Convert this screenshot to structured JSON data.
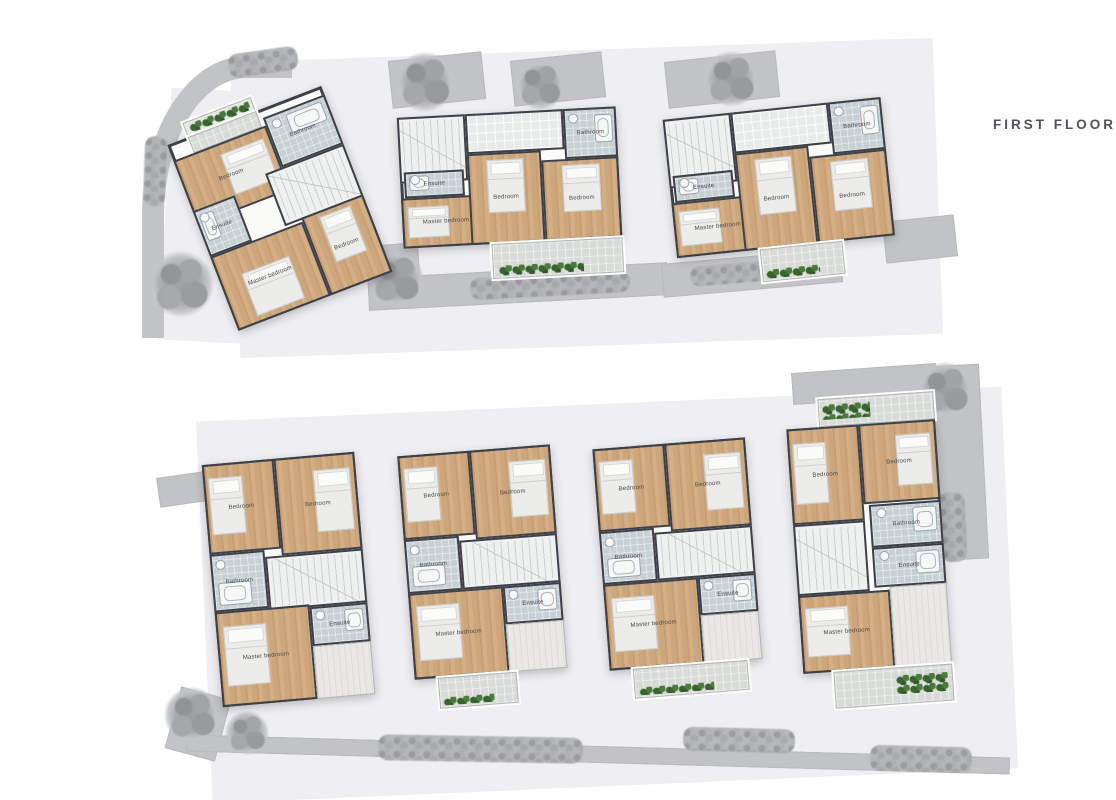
{
  "title": "FIRST FLOOR",
  "colors": {
    "wall": "#3d4147",
    "wood_floor": "#cfa97f",
    "bathroom_tile": "#c6d0d5",
    "paving": "#c2c3c5",
    "plot": "#efeff1",
    "plants": "#41702f",
    "title_text": "#4f5358"
  },
  "labels": {
    "bedroom": "Bedroom",
    "master": "Master bedroom",
    "bathroom": "Bathroom",
    "ensuite": "Ensuite"
  },
  "site": {
    "plots": [
      {
        "x": 235,
        "y": 50,
        "w": 703,
        "h": 296,
        "r": -2
      },
      {
        "x": 204,
        "y": 404,
        "w": 806,
        "h": 382,
        "r": -2.5
      },
      {
        "x": 165,
        "y": 90,
        "w": 95,
        "h": 252,
        "r": 3
      }
    ],
    "paving": [
      {
        "x": 390,
        "y": 56,
        "w": 94,
        "h": 48,
        "r": -6
      },
      {
        "x": 512,
        "y": 56,
        "w": 92,
        "h": 46,
        "r": -6
      },
      {
        "x": 666,
        "y": 56,
        "w": 112,
        "h": 47,
        "r": -6
      },
      {
        "x": 368,
        "y": 244,
        "w": 52,
        "h": 62,
        "r": -4
      },
      {
        "x": 368,
        "y": 270,
        "w": 300,
        "h": 33,
        "r": -3
      },
      {
        "x": 662,
        "y": 256,
        "w": 180,
        "h": 34,
        "r": -5
      },
      {
        "x": 884,
        "y": 218,
        "w": 72,
        "h": 42,
        "r": -6
      },
      {
        "x": 928,
        "y": 365,
        "w": 56,
        "h": 195,
        "r": -3
      },
      {
        "x": 792,
        "y": 368,
        "w": 145,
        "h": 32,
        "r": -4
      },
      {
        "x": 172,
        "y": 692,
        "w": 52,
        "h": 64,
        "r": 15
      },
      {
        "x": 158,
        "y": 474,
        "w": 55,
        "h": 30,
        "r": -8
      },
      {
        "x": 186,
        "y": 746,
        "w": 824,
        "h": 17,
        "r": 1.6
      }
    ],
    "hedges": [
      {
        "x": 228,
        "y": 50,
        "w": 70,
        "h": 24,
        "r": -8
      },
      {
        "x": 144,
        "y": 136,
        "w": 22,
        "h": 70,
        "r": 2
      },
      {
        "x": 470,
        "y": 274,
        "w": 160,
        "h": 22,
        "r": -3
      },
      {
        "x": 690,
        "y": 262,
        "w": 115,
        "h": 20,
        "r": -5
      },
      {
        "x": 378,
        "y": 736,
        "w": 205,
        "h": 26,
        "r": 1
      },
      {
        "x": 683,
        "y": 728,
        "w": 112,
        "h": 24,
        "r": 1.5
      },
      {
        "x": 870,
        "y": 746,
        "w": 102,
        "h": 26,
        "r": 1.5
      },
      {
        "x": 940,
        "y": 492,
        "w": 26,
        "h": 70,
        "r": -3
      }
    ],
    "trees": [
      {
        "x": 425,
        "y": 82,
        "d": 60
      },
      {
        "x": 540,
        "y": 85,
        "d": 50
      },
      {
        "x": 731,
        "y": 79,
        "d": 56
      },
      {
        "x": 181,
        "y": 284,
        "d": 66
      },
      {
        "x": 396,
        "y": 279,
        "d": 56
      },
      {
        "x": 945,
        "y": 390,
        "d": 56
      },
      {
        "x": 192,
        "y": 715,
        "d": 56
      },
      {
        "x": 247,
        "y": 733,
        "d": 44
      }
    ]
  },
  "houses": [
    {
      "x": 186,
      "y": 96,
      "w": 174,
      "h": 214,
      "r": -21,
      "shell": {
        "l": 5,
        "t": 7,
        "w": 95,
        "h": 93
      },
      "rooms": [
        {
          "type": "planter",
          "l": 18,
          "t": 0,
          "w": 42,
          "h": 7,
          "plants": "full"
        },
        {
          "type": "balcony",
          "l": 18,
          "t": 7,
          "w": 42,
          "h": 8
        },
        {
          "type": "bedroom",
          "label": "Bedroom",
          "l": 5,
          "t": 15,
          "w": 57,
          "h": 32,
          "bed": "right"
        },
        {
          "type": "bath",
          "label": "Bathroom",
          "l": 62,
          "t": 11,
          "w": 38,
          "h": 25,
          "tub": "top"
        },
        {
          "type": "stairs",
          "l": 52,
          "t": 36,
          "w": 48,
          "h": 26
        },
        {
          "type": "ensuite",
          "label": "Ensuite",
          "l": 5,
          "t": 40,
          "w": 26,
          "h": 23,
          "tub": "left"
        },
        {
          "type": "master",
          "label": "Master bedroom",
          "l": 5,
          "t": 63,
          "w": 57,
          "h": 37,
          "bed": "bottom"
        },
        {
          "type": "bedroom",
          "label": "Bedroom",
          "l": 62,
          "t": 61,
          "w": 38,
          "h": 39,
          "bed": "top"
        }
      ]
    },
    {
      "x": 401,
      "y": 112,
      "w": 219,
      "h": 166,
      "r": -3,
      "shell": {
        "l": 0,
        "t": 0,
        "w": 100,
        "h": 79
      },
      "rooms": [
        {
          "type": "stairs",
          "l": 0,
          "t": 0,
          "w": 31,
          "h": 40
        },
        {
          "type": "tile",
          "l": 31,
          "t": 0,
          "w": 45,
          "h": 24
        },
        {
          "type": "bath",
          "label": "Bathroom",
          "l": 76,
          "t": 0,
          "w": 24,
          "h": 30,
          "tub": "right"
        },
        {
          "type": "ensuite",
          "label": "Ensuite",
          "l": 2,
          "t": 33,
          "w": 27,
          "h": 16,
          "tub": "left"
        },
        {
          "type": "master",
          "label": "Master bedroom",
          "l": 0,
          "t": 49,
          "w": 40,
          "h": 30,
          "bed": "left"
        },
        {
          "type": "bedroom",
          "label": "Bedroom",
          "l": 31,
          "t": 24,
          "w": 34,
          "h": 55,
          "bed": "top"
        },
        {
          "type": "bedroom",
          "label": "Bedroom",
          "l": 65,
          "t": 30,
          "w": 35,
          "h": 49,
          "bed": "top"
        },
        {
          "type": "balcony",
          "l": 40,
          "t": 79,
          "w": 60,
          "h": 21,
          "plants": "bottom"
        }
      ]
    },
    {
      "x": 671,
      "y": 108,
      "w": 219,
      "h": 172,
      "r": -6,
      "shell": {
        "l": 0,
        "t": 0,
        "w": 100,
        "h": 81
      },
      "rooms": [
        {
          "type": "stairs",
          "l": 0,
          "t": 0,
          "w": 31,
          "h": 40
        },
        {
          "type": "tile",
          "l": 31,
          "t": 0,
          "w": 45,
          "h": 24
        },
        {
          "type": "bath",
          "label": "Bathroom",
          "l": 76,
          "t": 0,
          "w": 24,
          "h": 30,
          "tub": "right"
        },
        {
          "type": "ensuite",
          "label": "Ensuite",
          "l": 2,
          "t": 33,
          "w": 27,
          "h": 16,
          "tub": "left"
        },
        {
          "type": "master",
          "label": "Master bedroom",
          "l": 0,
          "t": 49,
          "w": 40,
          "h": 32,
          "bed": "left"
        },
        {
          "type": "bedroom",
          "label": "Bedroom",
          "l": 31,
          "t": 24,
          "w": 34,
          "h": 57,
          "bed": "top"
        },
        {
          "type": "bedroom",
          "label": "Bedroom",
          "l": 65,
          "t": 30,
          "w": 35,
          "h": 51,
          "bed": "top"
        },
        {
          "type": "balcony",
          "l": 38,
          "t": 81,
          "w": 38,
          "h": 19,
          "plants": "bottom"
        }
      ]
    },
    {
      "x": 212,
      "y": 458,
      "w": 153,
      "h": 243,
      "r": -5,
      "shell": {
        "l": 0,
        "t": 0,
        "w": 100,
        "h": 100
      },
      "rooms": [
        {
          "type": "bedroom",
          "label": "Bedroom",
          "l": 0,
          "t": 0,
          "w": 47,
          "h": 37,
          "bed": "left"
        },
        {
          "type": "bedroom",
          "label": "Bedroom",
          "l": 47,
          "t": 0,
          "w": 53,
          "h": 40,
          "bed": "right"
        },
        {
          "type": "bath",
          "label": "Bathroom",
          "l": 0,
          "t": 37,
          "w": 36,
          "h": 24,
          "tub": "bottom"
        },
        {
          "type": "stairs",
          "l": 36,
          "t": 40,
          "w": 64,
          "h": 22
        },
        {
          "type": "ensuite",
          "label": "Ensuite",
          "l": 62,
          "t": 62,
          "w": 38,
          "h": 16,
          "tub": "right"
        },
        {
          "type": "master",
          "label": "Master bedroom",
          "l": 0,
          "t": 61,
          "w": 62,
          "h": 39,
          "bed": "left"
        },
        {
          "type": "closet",
          "l": 62,
          "t": 78,
          "w": 38,
          "h": 22
        }
      ]
    },
    {
      "x": 407,
      "y": 450,
      "w": 153,
      "h": 255,
      "r": -4.5,
      "shell": {
        "l": 0,
        "t": 0,
        "w": 100,
        "h": 88
      },
      "rooms": [
        {
          "type": "bedroom",
          "label": "Bedroom",
          "l": 0,
          "t": 0,
          "w": 47,
          "h": 33,
          "bed": "left"
        },
        {
          "type": "bedroom",
          "label": "Bedroom",
          "l": 47,
          "t": 0,
          "w": 53,
          "h": 35,
          "bed": "right"
        },
        {
          "type": "bath",
          "label": "Bathroom",
          "l": 0,
          "t": 33,
          "w": 36,
          "h": 21,
          "tub": "bottom"
        },
        {
          "type": "stairs",
          "l": 36,
          "t": 35,
          "w": 64,
          "h": 19
        },
        {
          "type": "ensuite",
          "label": "Ensuite",
          "l": 62,
          "t": 54,
          "w": 38,
          "h": 15,
          "tub": "right"
        },
        {
          "type": "master",
          "label": "Master bedroom",
          "l": 0,
          "t": 54,
          "w": 62,
          "h": 34,
          "bed": "left"
        },
        {
          "type": "closet",
          "l": 62,
          "t": 69,
          "w": 38,
          "h": 19
        },
        {
          "type": "balcony",
          "l": 15,
          "t": 88,
          "w": 52,
          "h": 12,
          "plants": "bottom"
        }
      ]
    },
    {
      "x": 602,
      "y": 443,
      "w": 153,
      "h": 252,
      "r": -4.5,
      "shell": {
        "l": 0,
        "t": 0,
        "w": 100,
        "h": 88
      },
      "rooms": [
        {
          "type": "bedroom",
          "label": "Bedroom",
          "l": 0,
          "t": 0,
          "w": 47,
          "h": 33,
          "bed": "left"
        },
        {
          "type": "bedroom",
          "label": "Bedroom",
          "l": 47,
          "t": 0,
          "w": 53,
          "h": 35,
          "bed": "right"
        },
        {
          "type": "bath",
          "label": "Bathroom",
          "l": 0,
          "t": 33,
          "w": 36,
          "h": 21,
          "tub": "bottom"
        },
        {
          "type": "stairs",
          "l": 36,
          "t": 35,
          "w": 64,
          "h": 19
        },
        {
          "type": "ensuite",
          "label": "Ensuite",
          "l": 62,
          "t": 54,
          "w": 38,
          "h": 15,
          "tub": "right"
        },
        {
          "type": "master",
          "label": "Master bedroom",
          "l": 0,
          "t": 54,
          "w": 62,
          "h": 34,
          "bed": "left"
        },
        {
          "type": "closet",
          "l": 62,
          "t": 69,
          "w": 38,
          "h": 19
        },
        {
          "type": "balcony",
          "l": 15,
          "t": 88,
          "w": 75,
          "h": 12,
          "plants": "bottom"
        }
      ]
    },
    {
      "x": 795,
      "y": 396,
      "w": 149,
      "h": 310,
      "r": -4,
      "shell": {
        "l": 0,
        "t": 9,
        "w": 100,
        "h": 79
      },
      "rooms": [
        {
          "type": "balcony",
          "l": 22,
          "t": 0,
          "w": 78,
          "h": 9,
          "plants": "left"
        },
        {
          "type": "bedroom",
          "label": "Bedroom",
          "l": 0,
          "t": 9,
          "w": 48,
          "h": 31,
          "bed": "left"
        },
        {
          "type": "bedroom",
          "label": "Bedroom",
          "l": 48,
          "t": 9,
          "w": 52,
          "h": 26,
          "bed": "right"
        },
        {
          "type": "bath",
          "label": "Bathroom",
          "l": 52,
          "t": 35,
          "w": 48,
          "h": 14,
          "tub": "right"
        },
        {
          "type": "stairs",
          "l": 0,
          "t": 40,
          "w": 48,
          "h": 23
        },
        {
          "type": "ensuite",
          "label": "Ensuite",
          "l": 52,
          "t": 49,
          "w": 48,
          "h": 13,
          "tub": "right"
        },
        {
          "type": "master",
          "label": "Master bedroom",
          "l": 0,
          "t": 63,
          "w": 62,
          "h": 25,
          "bed": "left"
        },
        {
          "type": "closet",
          "l": 62,
          "t": 62,
          "w": 38,
          "h": 26
        },
        {
          "type": "balcony",
          "l": 20,
          "t": 88,
          "w": 80,
          "h": 12,
          "plants": "right"
        }
      ]
    }
  ]
}
